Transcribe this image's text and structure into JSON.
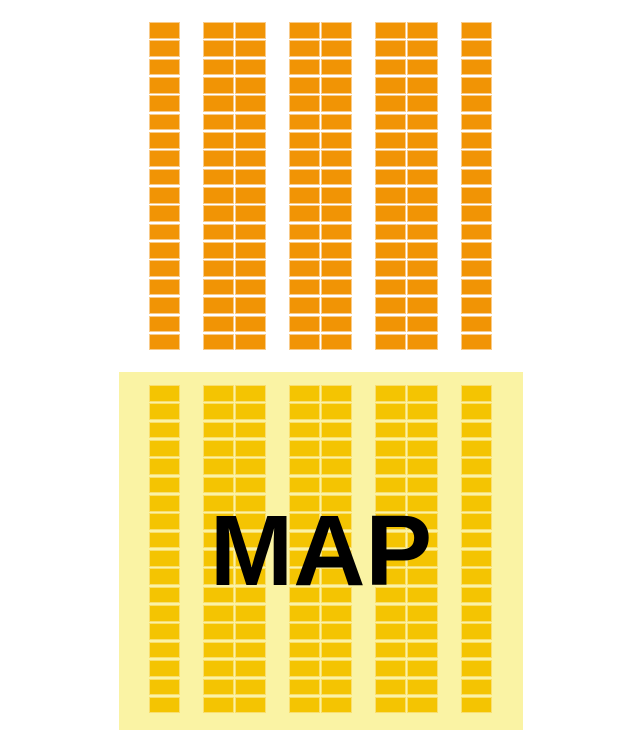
{
  "map_panel": {
    "label": "MAP"
  },
  "seat_map": {
    "rows": 18,
    "column_groups": [
      1,
      2,
      2,
      2,
      1
    ],
    "cells_per_section": 144,
    "sections": [
      "upper",
      "lower"
    ]
  },
  "colors": {
    "page_bg": "#ffffff",
    "upper_cell_fill": "#F19405",
    "upper_cell_border": "#F8CB8A",
    "panel_bg": "#FAF3A4",
    "lower_cell_fill": "#F4C402",
    "lower_cell_border": "#F9DE6E",
    "map_text": "#000000"
  }
}
